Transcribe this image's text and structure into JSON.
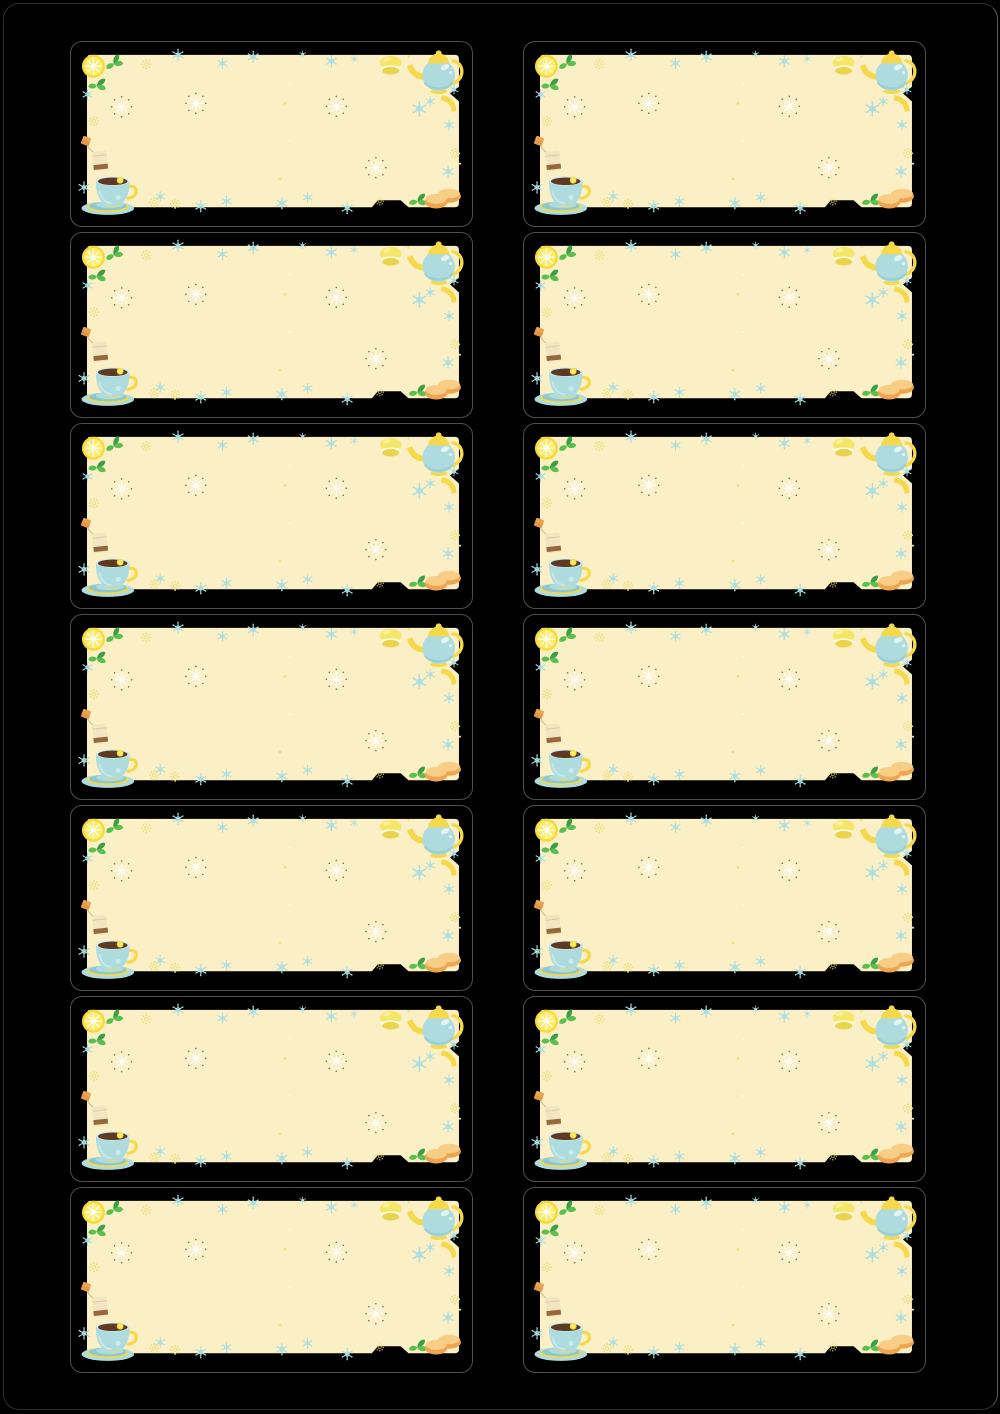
{
  "document": {
    "kind": "printable-blank-label-sheet",
    "theme": "tea-time",
    "background_color": "#000000",
    "text_content": ""
  },
  "sheet": {
    "rows": 7,
    "columns": 2,
    "label_count": 14,
    "label_text": "",
    "labels": [
      {
        "row": 1,
        "col": 1
      },
      {
        "row": 1,
        "col": 2
      },
      {
        "row": 2,
        "col": 1
      },
      {
        "row": 2,
        "col": 2
      },
      {
        "row": 3,
        "col": 1
      },
      {
        "row": 3,
        "col": 2
      },
      {
        "row": 4,
        "col": 1
      },
      {
        "row": 4,
        "col": 2
      },
      {
        "row": 5,
        "col": 1
      },
      {
        "row": 5,
        "col": 2
      },
      {
        "row": 6,
        "col": 1
      },
      {
        "row": 6,
        "col": 2
      },
      {
        "row": 7,
        "col": 1
      },
      {
        "row": 7,
        "col": 2
      }
    ]
  },
  "label_theme": {
    "decorations": [
      "lemon-slice",
      "mint-leaves",
      "teabag",
      "teacup-on-saucer",
      "macaron",
      "teapot",
      "lemon-wedge",
      "cookies",
      "mint-leaf",
      "blue-snowflakes",
      "yellow-flower-sparkles",
      "white-sparkle-bursts"
    ],
    "colors": {
      "cream": "#FBEFC5",
      "blue": "#AEDCDE",
      "blue_dark": "#8FC7CC",
      "yellow": "#F5D94B",
      "lemon_outer": "#F8D836",
      "lemon_inner": "#FCEC6C",
      "leaf": "#5ABF4E",
      "leaf_dark": "#3D9E44",
      "tea": "#5F3A23",
      "bag": "#F2E5C2",
      "bag_band": "#96683B",
      "tag": "#ECA351",
      "cookie": "#EFA54F",
      "cookie_top": "#F8CD86",
      "macaron": "#F5E667",
      "macaron_dark": "#EAD44E",
      "flake_blue": "#A9DEE2",
      "flake_yellow": "#EDE07E",
      "burst_dot": "#716C58",
      "white": "#FFFFFF",
      "cut_line": "#4E4E4E",
      "page_outline": "#2F2F2F"
    }
  }
}
